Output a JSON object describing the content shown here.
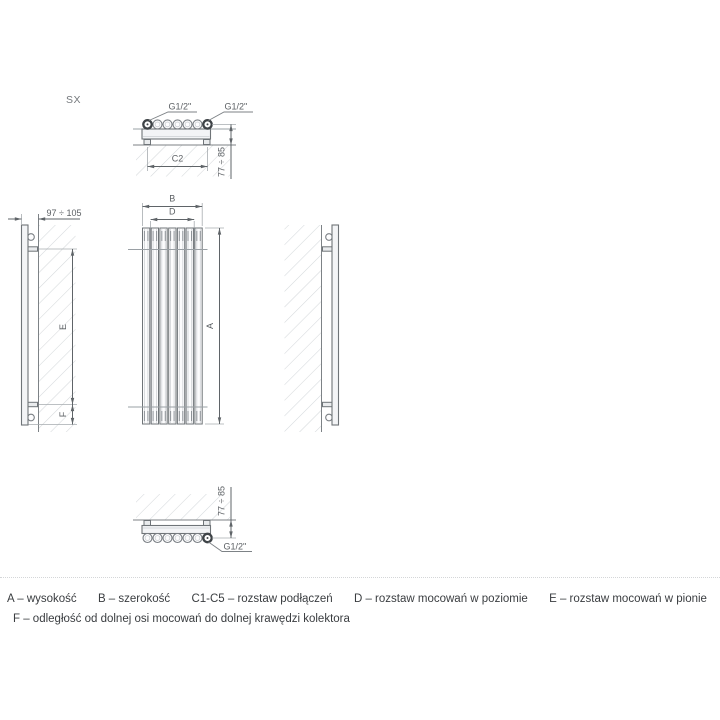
{
  "page": {
    "background": "#ffffff"
  },
  "drawing": {
    "model_label": "SX",
    "colors": {
      "outline": "#6f7478",
      "dimension": "#5f6468",
      "extension": "#a6abaf",
      "hatch": "#d5d8db",
      "fill_light": "#f3f4f6",
      "fitting_dark": "#3e4347",
      "label_text": "#5c6064",
      "legend_text": "#3a3d40"
    },
    "labels": {
      "top_conn_left": "G1/2\"",
      "top_conn_right": "G1/2\"",
      "top_spacing": "C2",
      "top_depth": "77 ÷ 85",
      "front_width": "B",
      "front_mount_h": "D",
      "front_height": "A",
      "side_depth": "97 ÷ 105",
      "side_mount_v": "E",
      "side_offset": "F",
      "bottom_depth": "77 ÷ 85",
      "bottom_conn": "G1/2\""
    }
  },
  "legend": {
    "row1": [
      "A – wysokość",
      "B – szerokość",
      "C1-C5 – rozstaw podłączeń",
      "D – rozstaw mocowań w poziomie",
      "E – rozstaw mocowań w pionie"
    ],
    "row2": "F – odległość od dolnej osi mocowań do dolnej krawędzi kolektora"
  }
}
